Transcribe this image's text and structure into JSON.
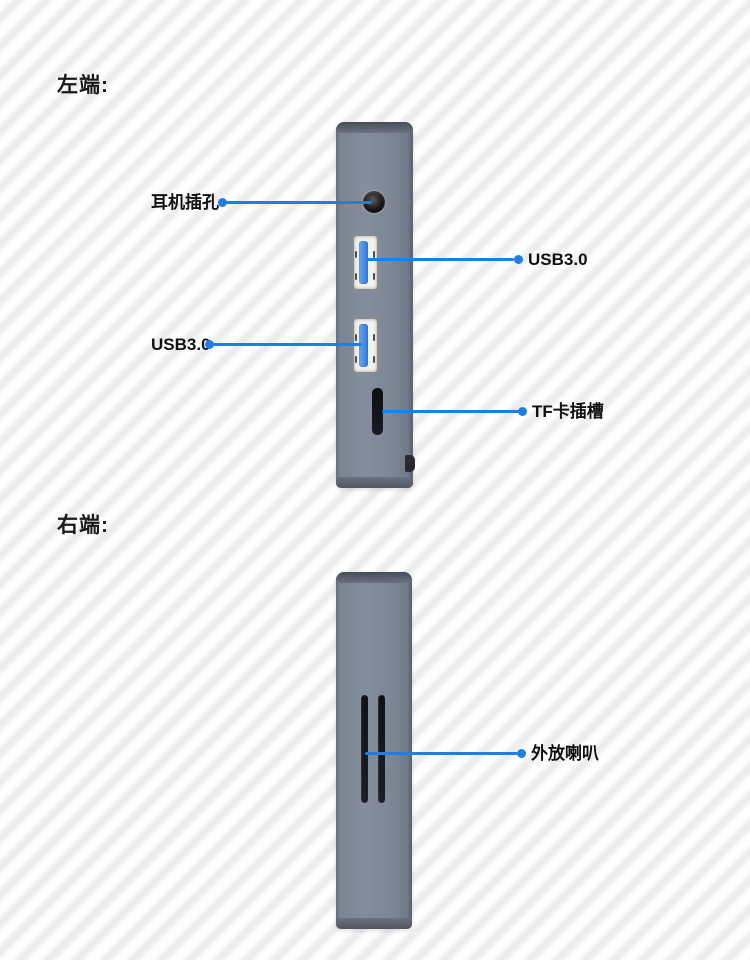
{
  "colors": {
    "accent_blue": "#1e7ee3",
    "device_body_gray": "#7d8694",
    "stripe_gray": "#ededef",
    "text": "#1a1a1a"
  },
  "sections": {
    "left_end": {
      "heading": "左端:",
      "callouts": {
        "headphone": {
          "label": "耳机插孔"
        },
        "usb_top": {
          "label": "USB3.0"
        },
        "usb_bottom": {
          "label": "USB3.0"
        },
        "tf": {
          "label": "TF卡插槽"
        }
      }
    },
    "right_end": {
      "heading": "右端:",
      "callouts": {
        "speaker": {
          "label": "外放喇叭"
        }
      }
    }
  }
}
